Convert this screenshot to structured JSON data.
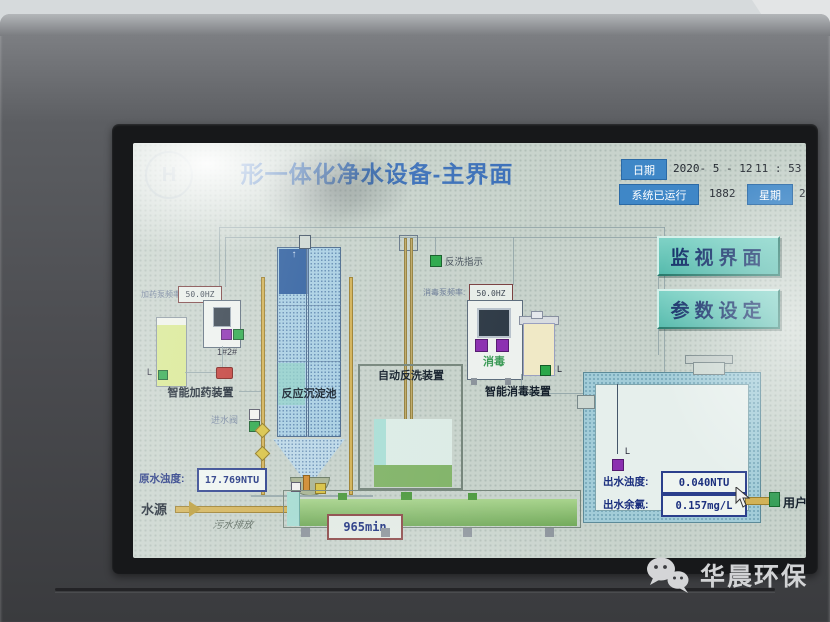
{
  "photo": {
    "watermark": "华晨环保"
  },
  "screen": {
    "logo_letter": "H",
    "title": "形一体化净水设备-主界面",
    "status": {
      "date_label": "日期",
      "date_value": "2020- 5 - 12",
      "time_value": "11 : 53 : 5",
      "runtime_label": "系统已运行",
      "runtime_value": "1882",
      "week_label": "星期",
      "week_value": "2"
    },
    "buttons": {
      "monitor": "监视界面",
      "params": "参数设定"
    },
    "dosing": {
      "name": "智能加药装置",
      "freq_label": "加药泵频率:",
      "freq_value": "50.0HZ",
      "pumps": "1#2#",
      "level": "L"
    },
    "sedimentation": {
      "name": "反应沉淀池",
      "inlet_valve": "进水阀"
    },
    "backwash": {
      "name": "自动反洗装置",
      "indicator": "反洗指示"
    },
    "disinfection": {
      "name": "智能消毒装置",
      "freq_label": "消毒泵频率:",
      "freq_value": "50.0HZ",
      "unit_text": "消毒",
      "level": "L"
    },
    "clear_tank": {
      "turbidity_label": "出水浊度:",
      "turbidity_value": "0.040NTU",
      "chlorine_label": "出水余氯:",
      "chlorine_value": "0.157mg/L",
      "level": "L",
      "user": "用户"
    },
    "raw_water": {
      "turbidity_label": "原水浊度:",
      "turbidity_value": "17.769NTU",
      "source": "水源"
    },
    "drain": {
      "name": "污水排放",
      "timer": "965min"
    }
  }
}
